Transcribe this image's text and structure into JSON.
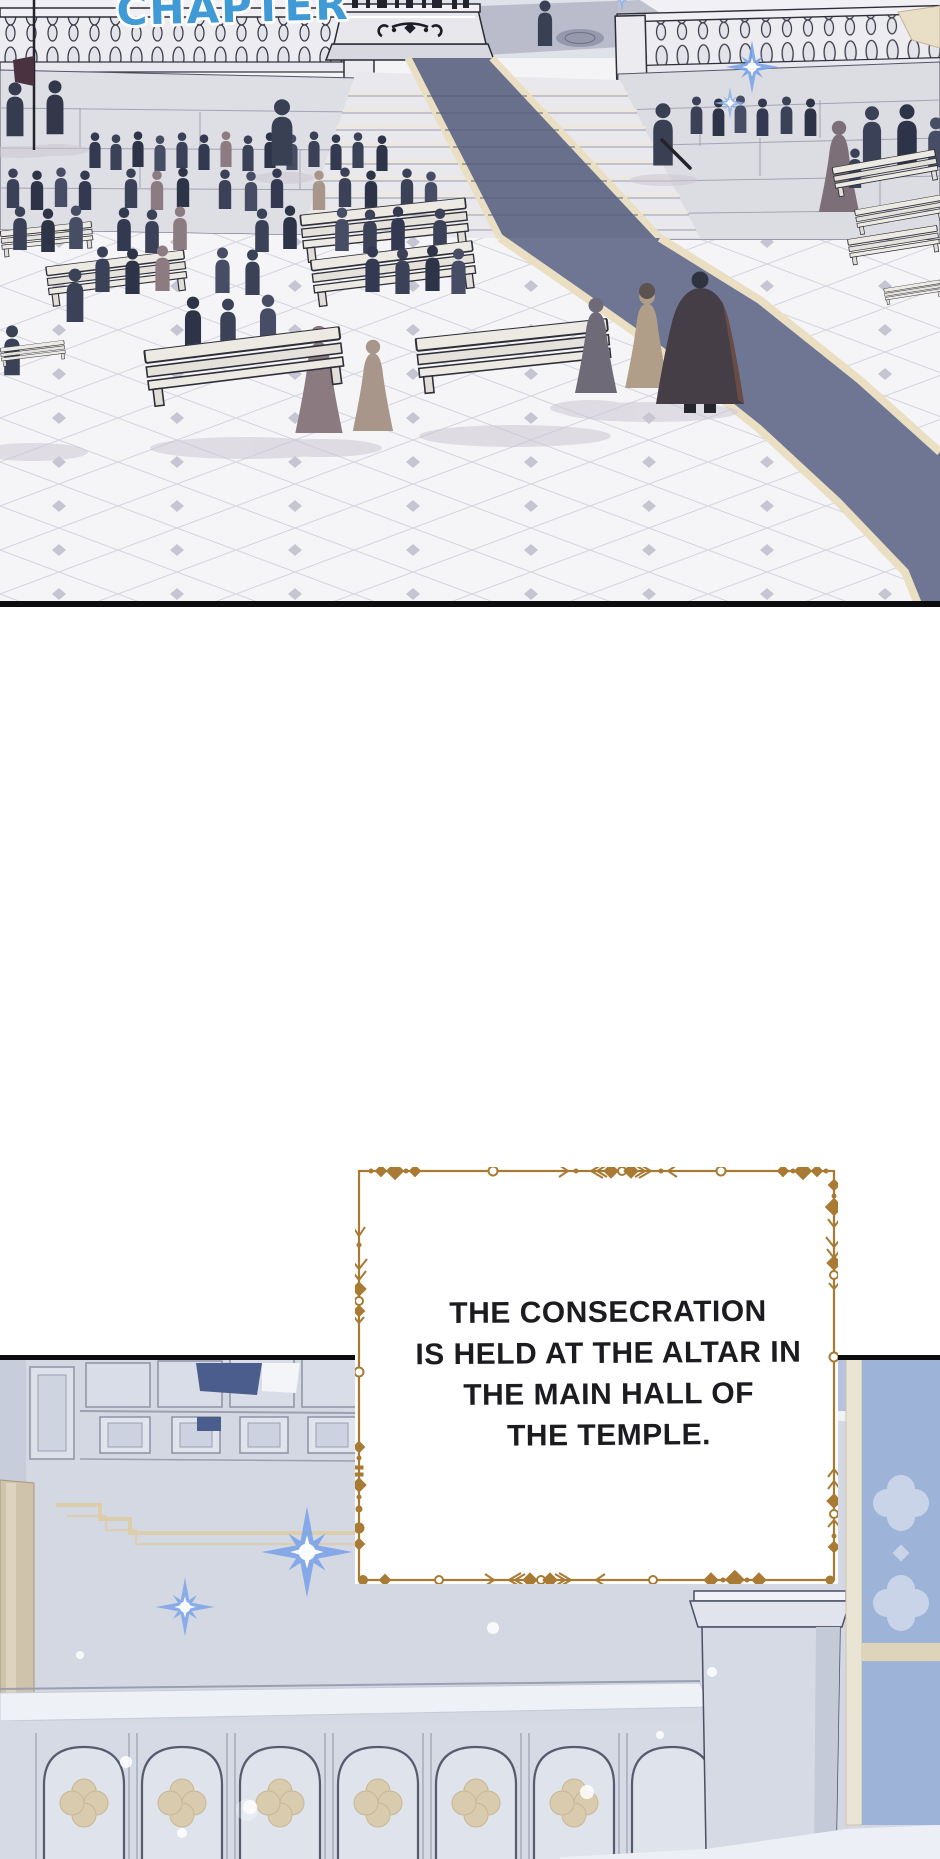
{
  "comic": {
    "chapter_label": "CHAPTER",
    "narration_box": {
      "full_text": "THE CONSECRATION IS HELD AT THE ALTAR IN THE MAIN HALL OF THE TEMPLE.",
      "lines": [
        "THE CONSECRATION",
        "IS HELD AT THE ALTAR IN",
        "THE MAIN HALL OF",
        "THE TEMPLE."
      ]
    },
    "colors": {
      "chapter_text_blue": "#3f9ad6",
      "narration_border_gold": "#a97a33",
      "carpet_slate": "#6b7390",
      "carpet_trim_cream": "#eadfc3",
      "crowd_silhouette": "#3b4156",
      "plaza_stone": "#e2e2e8",
      "hall_wall_blue_gray": "#d3d8e3",
      "stained_glass_navy": "#4b5d8c",
      "stained_glass_light": "#9db3d8",
      "quatrefoil_beige": "#d9cbae",
      "sparkle_blue": "#7da4e8",
      "panel_border_black": "#0d0d10"
    },
    "icons": {
      "sparkle_icon_glyph": "✦",
      "light_dot_icon_glyph": "•"
    }
  }
}
